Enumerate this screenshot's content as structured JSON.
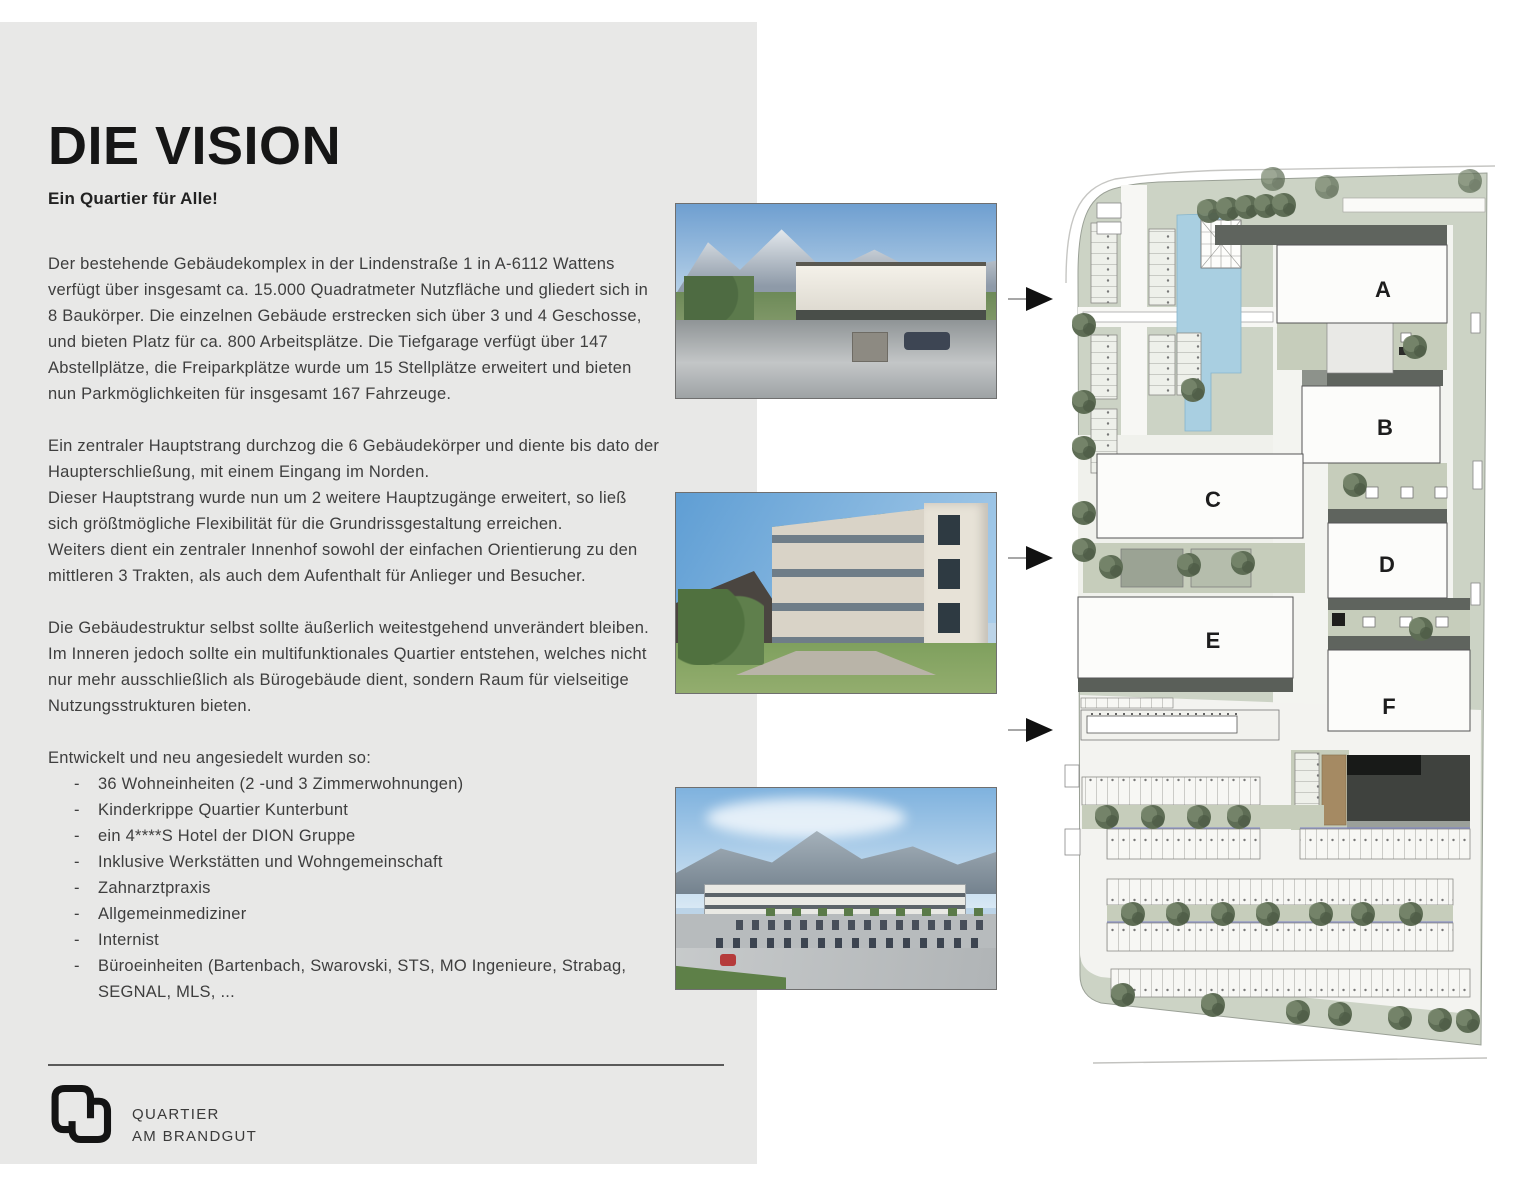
{
  "document": {
    "title": "DIE VISION",
    "subtitle": "Ein Quartier für Alle!",
    "p1": "Der bestehende Gebäudekomplex in der Lindenstraße 1 in A-6112 Wattens verfügt über insgesamt ca. 15.000 Quadratmeter Nutzfläche und gliedert sich in 8 Baukörper. Die einzelnen Gebäude erstrecken sich über 3 und 4 Geschosse, und bieten Platz für ca. 800 Arbeitsplätze. Die Tiefgarage verfügt über 147 Abstellplätze, die Freiparkplätze wurde um 15 Stellplätze erweitert und bieten nun Parkmöglichkeiten für insgesamt 167 Fahrzeuge.",
    "p2a": "Ein zentraler Hauptstrang durchzog die 6 Gebäudekörper und diente bis dato der Haupterschließung, mit einem Eingang im Norden.",
    "p2b": "Dieser Hauptstrang wurde nun um 2 weitere Hauptzugänge erweitert, so ließ sich größtmögliche Flexibilität für die Grundrissgestaltung erreichen.",
    "p2c": "Weiters dient ein zentraler Innenhof sowohl der einfachen Orientierung zu den mittleren 3 Trakten, als auch dem Aufenthalt für Anlieger und Besucher.",
    "p3": "Die Gebäudestruktur selbst sollte äußerlich weitestgehend unverändert bleiben. Im Inneren jedoch sollte ein multifunktionales Quartier entstehen, welches nicht nur mehr ausschließlich als Bürogebäude dient, sondern Raum für vielseitige Nutzungsstrukturen bieten.",
    "list_intro": "Entwickelt und neu angesiedelt wurden so:",
    "bullet": "-",
    "list_items": [
      "36 Wohneinheiten (2 -und 3 Zimmerwohnungen)",
      "Kinderkrippe Quartier Kunterbunt",
      "ein 4****S Hotel der DION Gruppe",
      "Inklusive Werkstätten und Wohngemeinschaft",
      "Zahnarztpraxis",
      "Allgemeinmediziner",
      "Internist",
      "Büroeinheiten (Bartenbach, Swarovski, STS, MO Ingenieure, Strabag, SEGNAL, MLS, ..."
    ]
  },
  "logo": {
    "line1": "QUARTIER",
    "line2": "AM BRANDGUT"
  },
  "site_plan": {
    "building_labels": [
      "A",
      "B",
      "C",
      "D",
      "E",
      "F"
    ]
  },
  "colors": {
    "band_gray": "#e8e8e7",
    "plan_green": "#ccd3c5",
    "plan_water": "#a9cfe1",
    "plan_dark_band": "#5f645e",
    "plan_brown": "#a58a63",
    "tree_green": "#5e6d55",
    "arrow_black": "#111111",
    "text": "#3e3e3e"
  }
}
